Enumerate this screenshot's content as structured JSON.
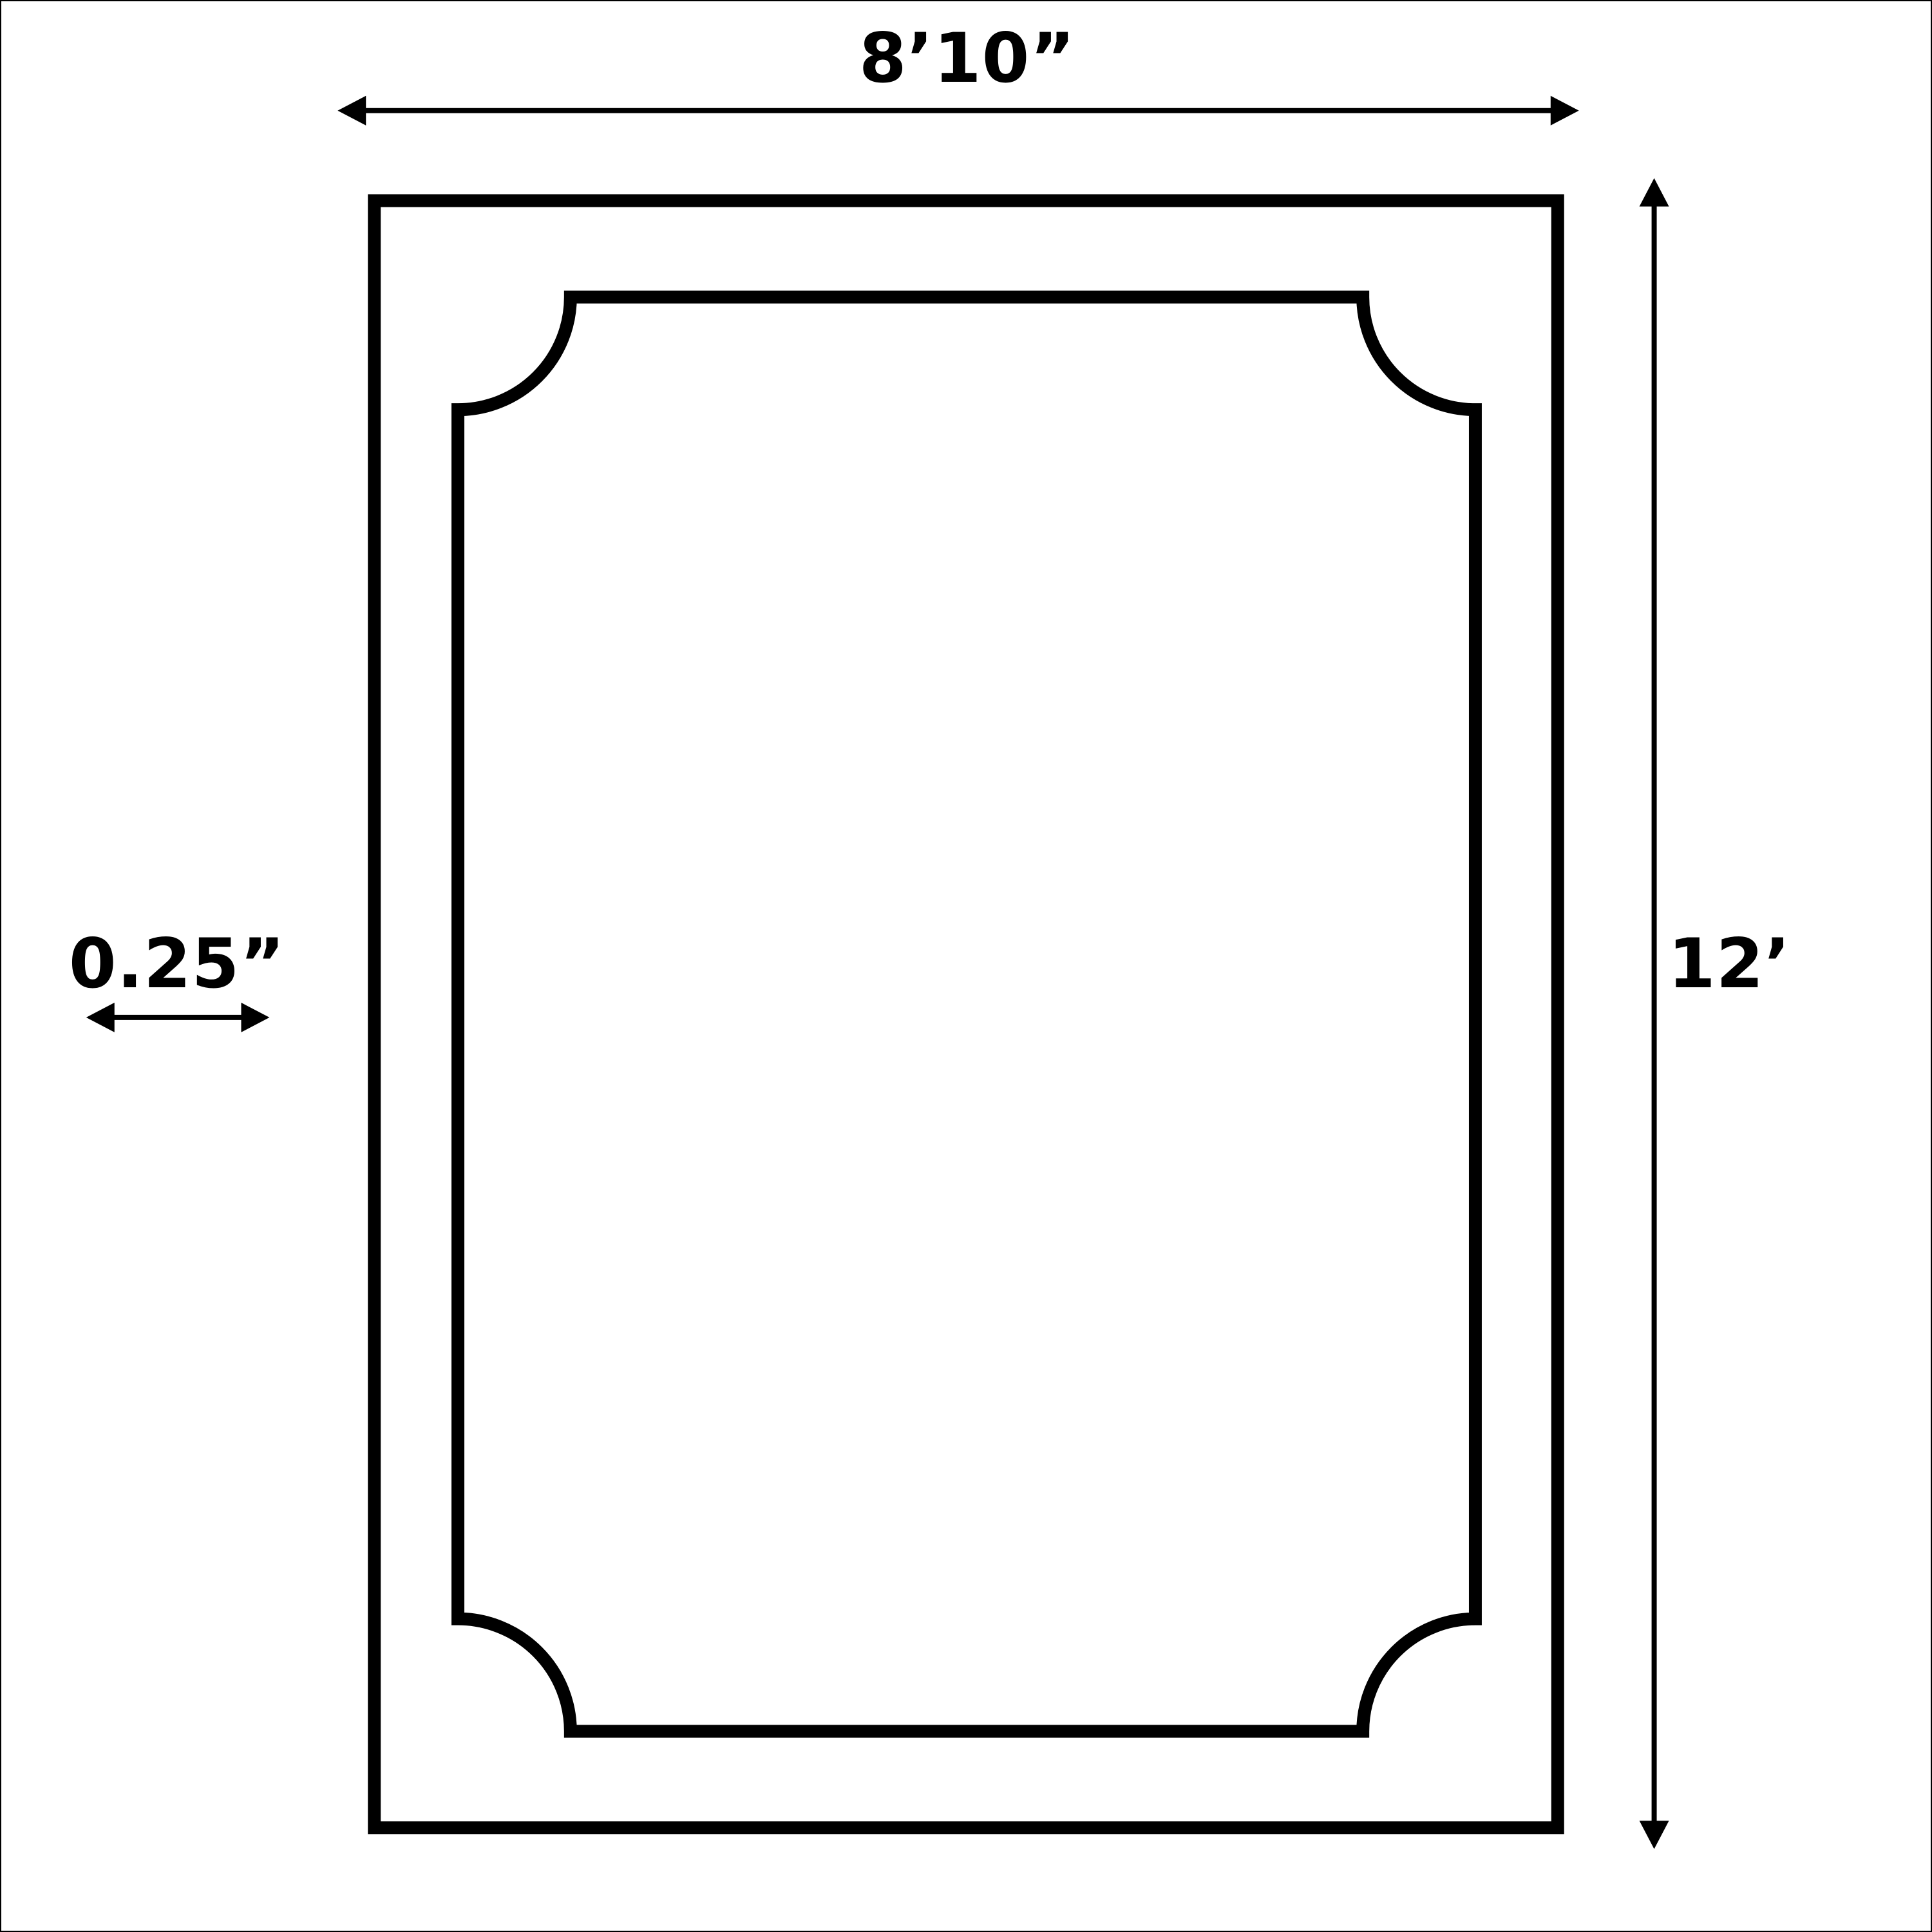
{
  "diagram": {
    "type": "dimension-drawing",
    "shape": "rectangle-with-notched-corner-inner-border",
    "dimensions": {
      "width": {
        "label": "8’10”"
      },
      "height": {
        "label": "12’"
      },
      "thickness": {
        "label": "0.25”"
      }
    },
    "colors": {
      "line": "#000000",
      "background": "#ffffff"
    }
  }
}
